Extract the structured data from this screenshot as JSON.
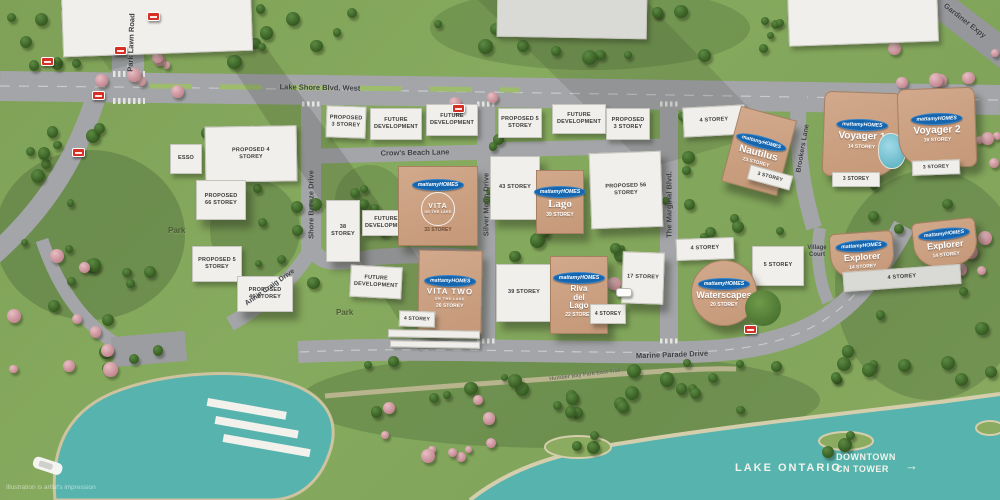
{
  "disclaimer": "Illustration is artist's impression",
  "brand": {
    "label": "mattamyHOMES",
    "color": "#1565af"
  },
  "roads": {
    "park_lawn": "Park Lawn Road",
    "lake_shore": "Lake Shore Blvd. West",
    "gardiner": "Gardiner Expy",
    "crows_beach": "Crow's Beach Lane",
    "shore_breeze": "Shore Breeze Drive",
    "silver_moon": "Silver Moon Drive",
    "annie_craig": "Annie Craig Drive",
    "marginal": "The Marginal Blvd.",
    "brookers": "Brookers Lane",
    "village_court": "Village Court",
    "marine_parade": "Marine Parade Drive",
    "humber_trail": "Humber Bay Park East Trail"
  },
  "places": {
    "park": "Park",
    "esso": "ESSO",
    "lake": "LAKE ONTARIO",
    "downtown_line1": "DOWNTOWN",
    "downtown_line2": "CN TOWER",
    "downtown_arrow": "→"
  },
  "labels": {
    "future_development": "FUTURE DEVELOPMENT",
    "s3": "3 STOREY",
    "s4": "4 STOREY",
    "s5": "5 STOREY",
    "t17": "17 STOREY",
    "t38": "38 STOREY",
    "t39": "39 STOREY",
    "t43": "43 STOREY",
    "proposed_3": "PROPOSED 3 STOREY",
    "proposed_4": "PROPOSED 4 STOREY",
    "proposed_5": "PROPOSED 5 STOREY",
    "proposed_46": "PROPOSED 46 STOREY",
    "proposed_56": "PROPOSED 56 STOREY",
    "proposed_66": "PROPOSED 66 STOREY"
  },
  "developments": {
    "vita": {
      "name": "VITA",
      "tagline": "ON THE LAKE",
      "storeys": "33 STOREY"
    },
    "vita_two": {
      "name": "VITA TWO",
      "tagline": "ON THE LAKE",
      "storeys": "26 STOREY"
    },
    "lago": {
      "name": "Lago",
      "storeys": "39 STOREY"
    },
    "riva": {
      "name": "Riva del Lago",
      "storeys": "22 STOREY"
    },
    "nautilus": {
      "name": "Nautilus",
      "storeys": "23 STOREY"
    },
    "waterscapes": {
      "name": "Waterscapes",
      "storeys": "20 STOREY"
    },
    "explorer": {
      "name": "Explorer",
      "storeys": "14 STOREY"
    },
    "voyager1": {
      "name": "Voyager 1",
      "storeys": "14 STOREY"
    },
    "voyager2": {
      "name": "Voyager 2",
      "storeys": "16 STOREY"
    }
  },
  "colors": {
    "grass": "#85a75c",
    "road": "#a4a5a9",
    "water": "#57b3ae",
    "tan_building": "#c9a083",
    "white_building": "#f0efeb",
    "brand_blue": "#1565af"
  }
}
